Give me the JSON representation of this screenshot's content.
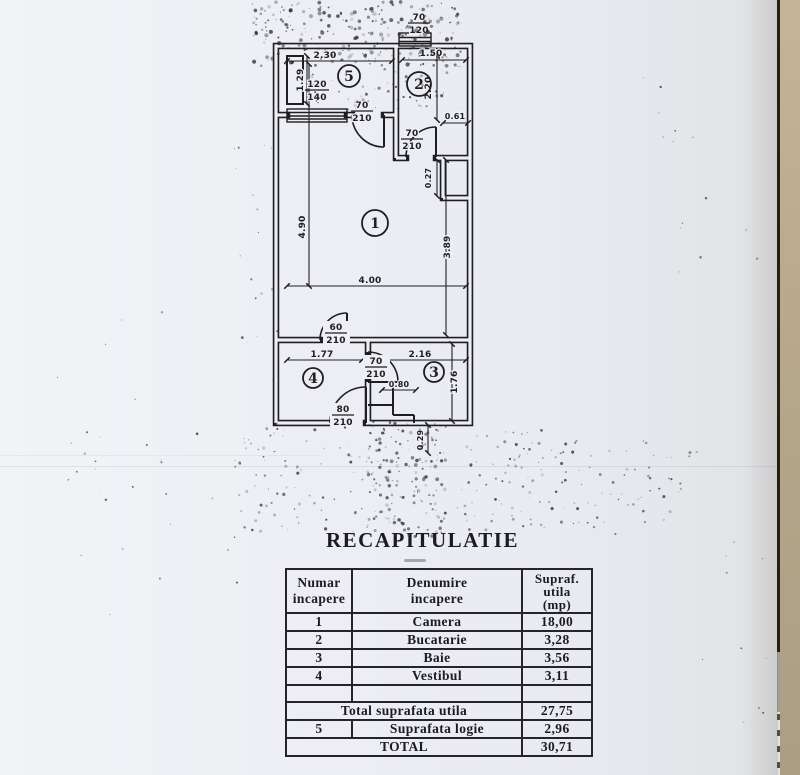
{
  "title": "RECAPITULATIE",
  "plan": {
    "rooms": {
      "camera": "1",
      "bucatarie": "2",
      "baie": "3",
      "vestibul": "4",
      "logie": "5"
    },
    "dims": {
      "top_window": {
        "w": "70",
        "h": "120"
      },
      "logia_width": "2.30",
      "kitchen_width": "1.50",
      "logia_side": "1.29",
      "logia_window": {
        "w": "120",
        "h": "140"
      },
      "logia_door": {
        "w": "70",
        "h": "210"
      },
      "kitchen_height": "2.20",
      "kitchen_niche": "0.61",
      "kitchen_door": {
        "w": "70",
        "h": "210"
      },
      "niche_depth": "0.27",
      "room_left": "4.90",
      "room_right": "3.89",
      "room_width": "4.00",
      "hall_door": {
        "w": "60",
        "h": "210"
      },
      "hall_width": "1.77",
      "bath_width": "2.16",
      "bath_height": "1.76",
      "bath_clear": "0.80",
      "bath_door": {
        "w": "70",
        "h": "210"
      },
      "entry_door": {
        "w": "80",
        "h": "210"
      },
      "exterior_offset": "0.29"
    }
  },
  "table": {
    "headers": {
      "col1": [
        "Numar",
        "incapere"
      ],
      "col2": [
        "Denumire",
        "incapere"
      ],
      "col3": [
        "Supraf.",
        "utila",
        "(mp)"
      ]
    },
    "rows": [
      {
        "num": "1",
        "name": "Camera",
        "area": "18,00"
      },
      {
        "num": "2",
        "name": "Bucatarie",
        "area": "3,28"
      },
      {
        "num": "3",
        "name": "Baie",
        "area": "3,56"
      },
      {
        "num": "4",
        "name": "Vestibul",
        "area": "3,11"
      }
    ],
    "total_utila": {
      "label": "Total suprafata utila",
      "value": "27,75"
    },
    "logie_row": {
      "num": "5",
      "label": "Suprafata logie",
      "value": "2,96"
    },
    "total": {
      "label": "TOTAL",
      "value": "30,71"
    }
  },
  "colors": {
    "ink": "#1f1e22",
    "paper": "#edeff4",
    "photo_edge": "#b4a689"
  }
}
